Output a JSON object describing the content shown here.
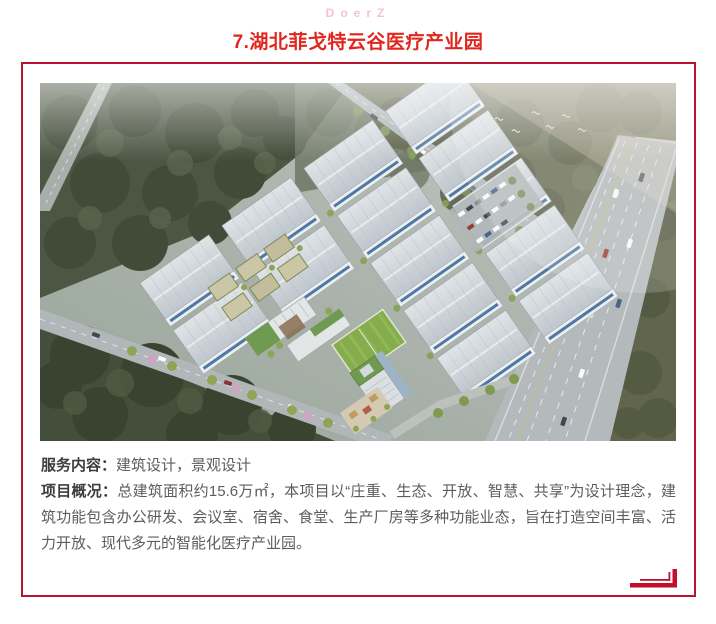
{
  "header": {
    "brand": "DoerZ",
    "brand_color": "#f6c3c8",
    "title": "7.湖北菲戈特云谷医疗产业园",
    "title_color": "#e0261d"
  },
  "card": {
    "border_color": "#b9142e",
    "footer_icon": "corner-frame-icon",
    "footer_icon_color": "#c20f2b"
  },
  "hero_image": {
    "subject": "湖北菲戈特云谷医疗产业园鸟瞰效果图"
  },
  "content": {
    "service_label": "服务内容：",
    "service_text": "建筑设计，景观设计",
    "overview_label": "项目概况：",
    "overview_text": "总建筑面积约15.6万㎡，本项目以“庄重、生态、开放、智慧、共享”为设计理念，建筑功能包含办公研发、会议室、宿舍、食堂、生产厂房等多种功能业态，旨在打造空间丰富、活力开放、现代多元的智能化医疗产业园。"
  }
}
